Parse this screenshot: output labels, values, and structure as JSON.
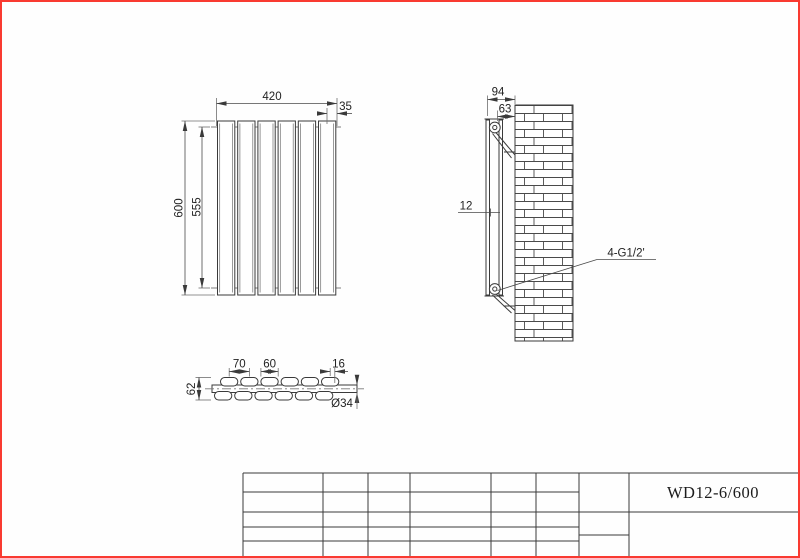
{
  "drawing": {
    "front_view": {
      "width": "420",
      "end_offset": "35",
      "height": "600",
      "inner_height": "555"
    },
    "side_view": {
      "total_depth": "94",
      "bracket_depth": "63",
      "panel_gap": "12",
      "thread_callout": "4-G1/2'"
    },
    "top_view": {
      "panel_pitch": "70",
      "panel_length": "60",
      "end_offset": "16",
      "depth": "62",
      "tube_diameter": "Ø34"
    },
    "title_block": {
      "model": "WD12-6/600"
    },
    "colors": {
      "frame_border": "#f93a31",
      "object_line": "#3a3a3a"
    }
  }
}
